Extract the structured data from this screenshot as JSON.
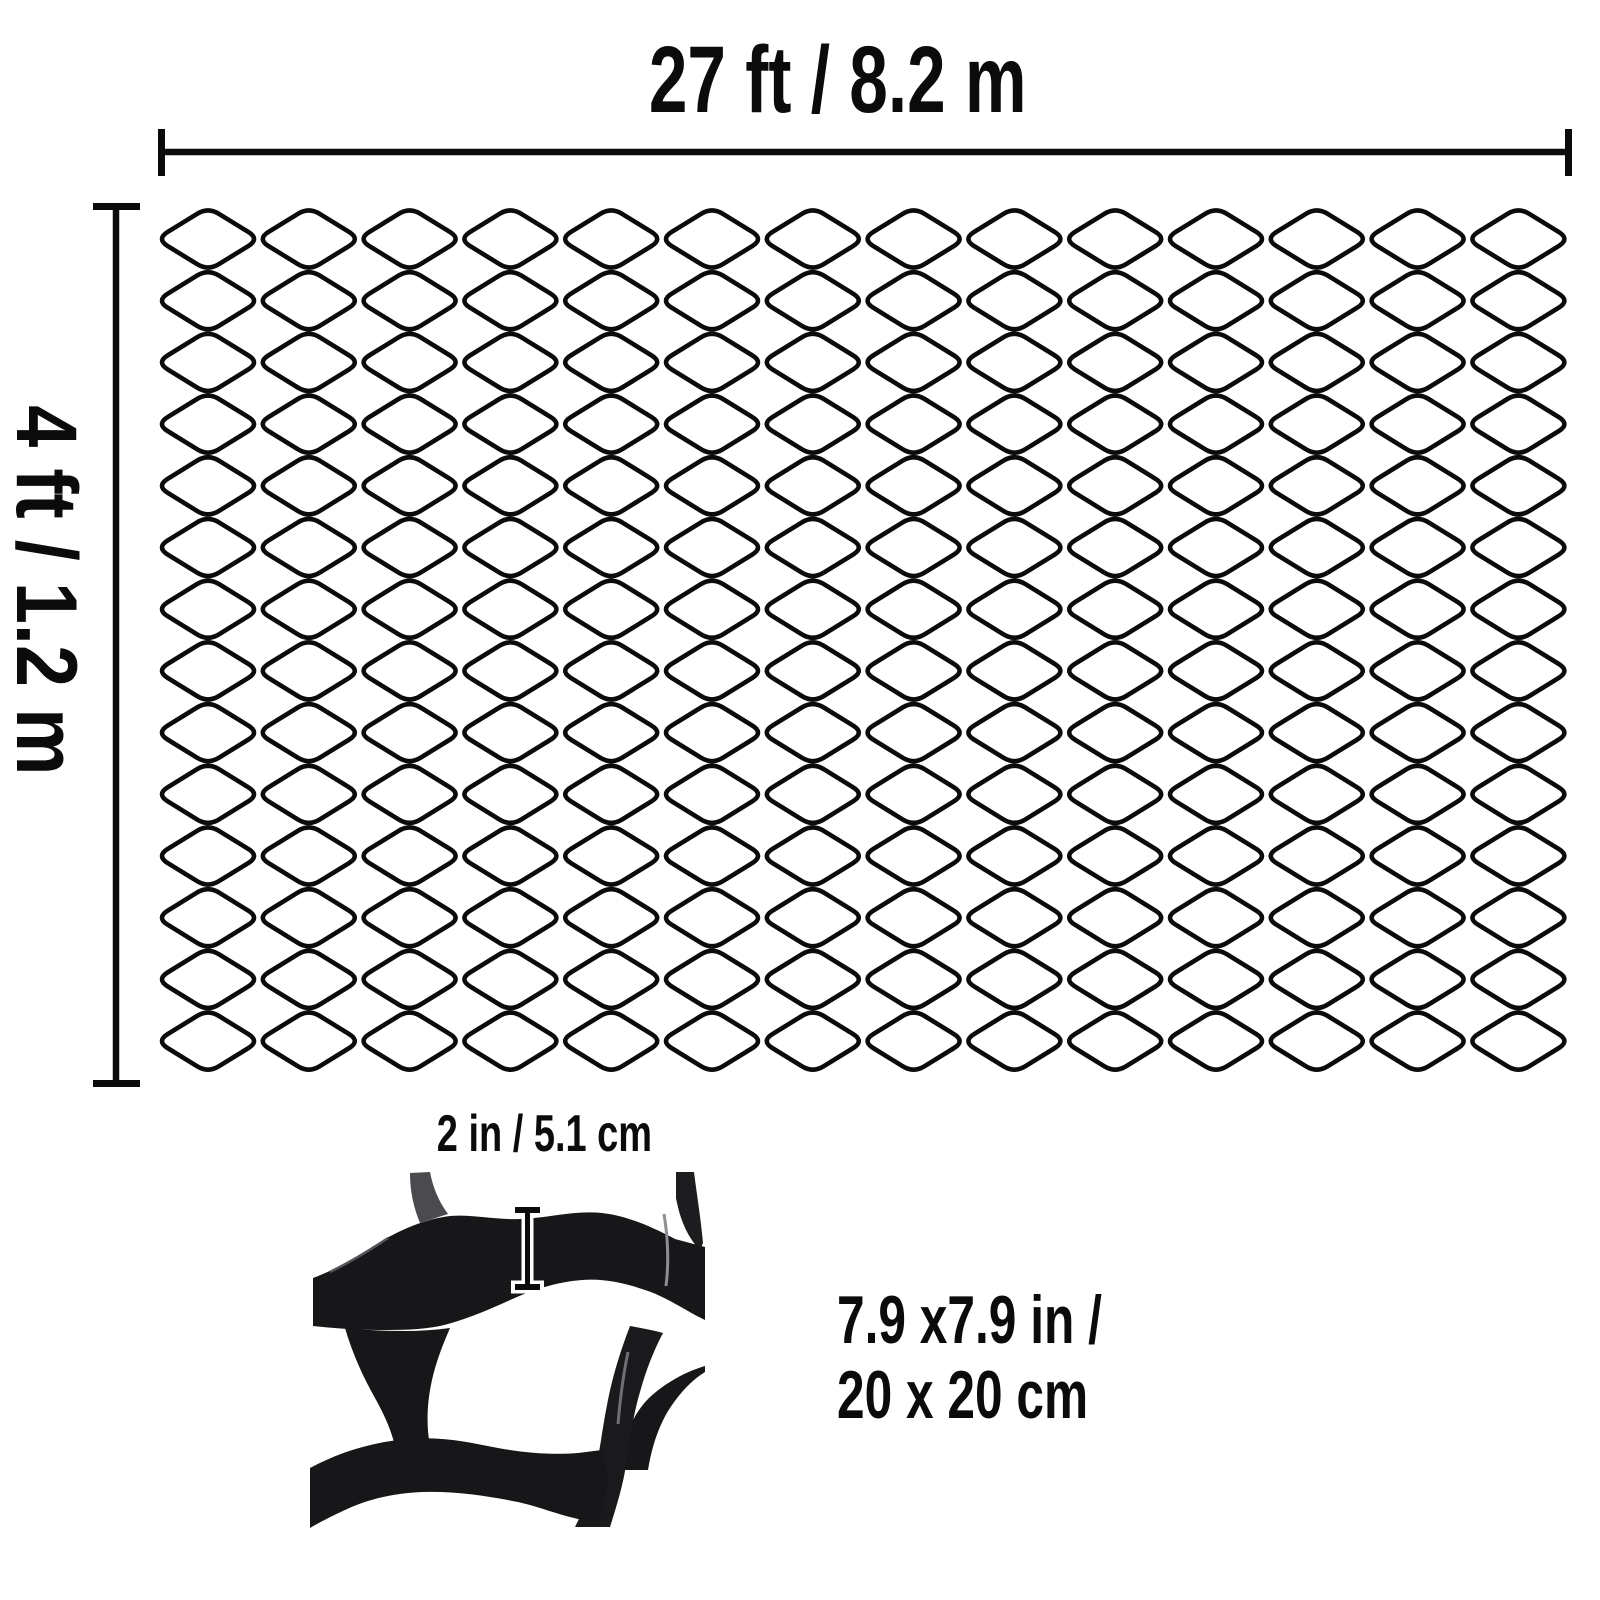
{
  "title": "Geocell ground grid dimension diagram",
  "labels": {
    "width": "27 ft / 8.2 m",
    "height": "4 ft / 1.2 m",
    "strip_height": "2 in / 5.1 cm",
    "cell_size_line1": "7.9 x7.9 in /",
    "cell_size_line2": "20 x 20 cm"
  },
  "colors": {
    "ink": "#0b0b0b",
    "background": "#ffffff",
    "photo_dark": "#17171a",
    "photo_dark2": "#1d1d20",
    "photo_gray": "#4a4a4f",
    "photo_highlight": "#8d8d92",
    "photo_highlight2": "#6f6f75",
    "marker_outline": "#ffffff"
  },
  "mesh": {
    "columns": 14,
    "rows": 14,
    "origin_x": 208,
    "origin_y": 239,
    "spacing_x": 100.8,
    "spacing_y": 61.7,
    "cell_half_width": 51.5,
    "cell_half_height": 32,
    "tip_cut": 13,
    "stroke_width": 4.6
  },
  "dimension_lines": {
    "top": {
      "x1": 158,
      "x2": 1572,
      "y": 152,
      "tick_top": 129,
      "tick_bottom": 176,
      "line_width": 6.5,
      "tick_width": 7
    },
    "left": {
      "y1": 203,
      "y2": 1087,
      "x": 116,
      "tick_left": 93,
      "tick_right": 140,
      "line_width": 6.5,
      "tick_width": 7
    }
  },
  "marker": {
    "x": 527.5,
    "y1": 1210,
    "y2": 1287,
    "cap_half_width": 12.5
  }
}
